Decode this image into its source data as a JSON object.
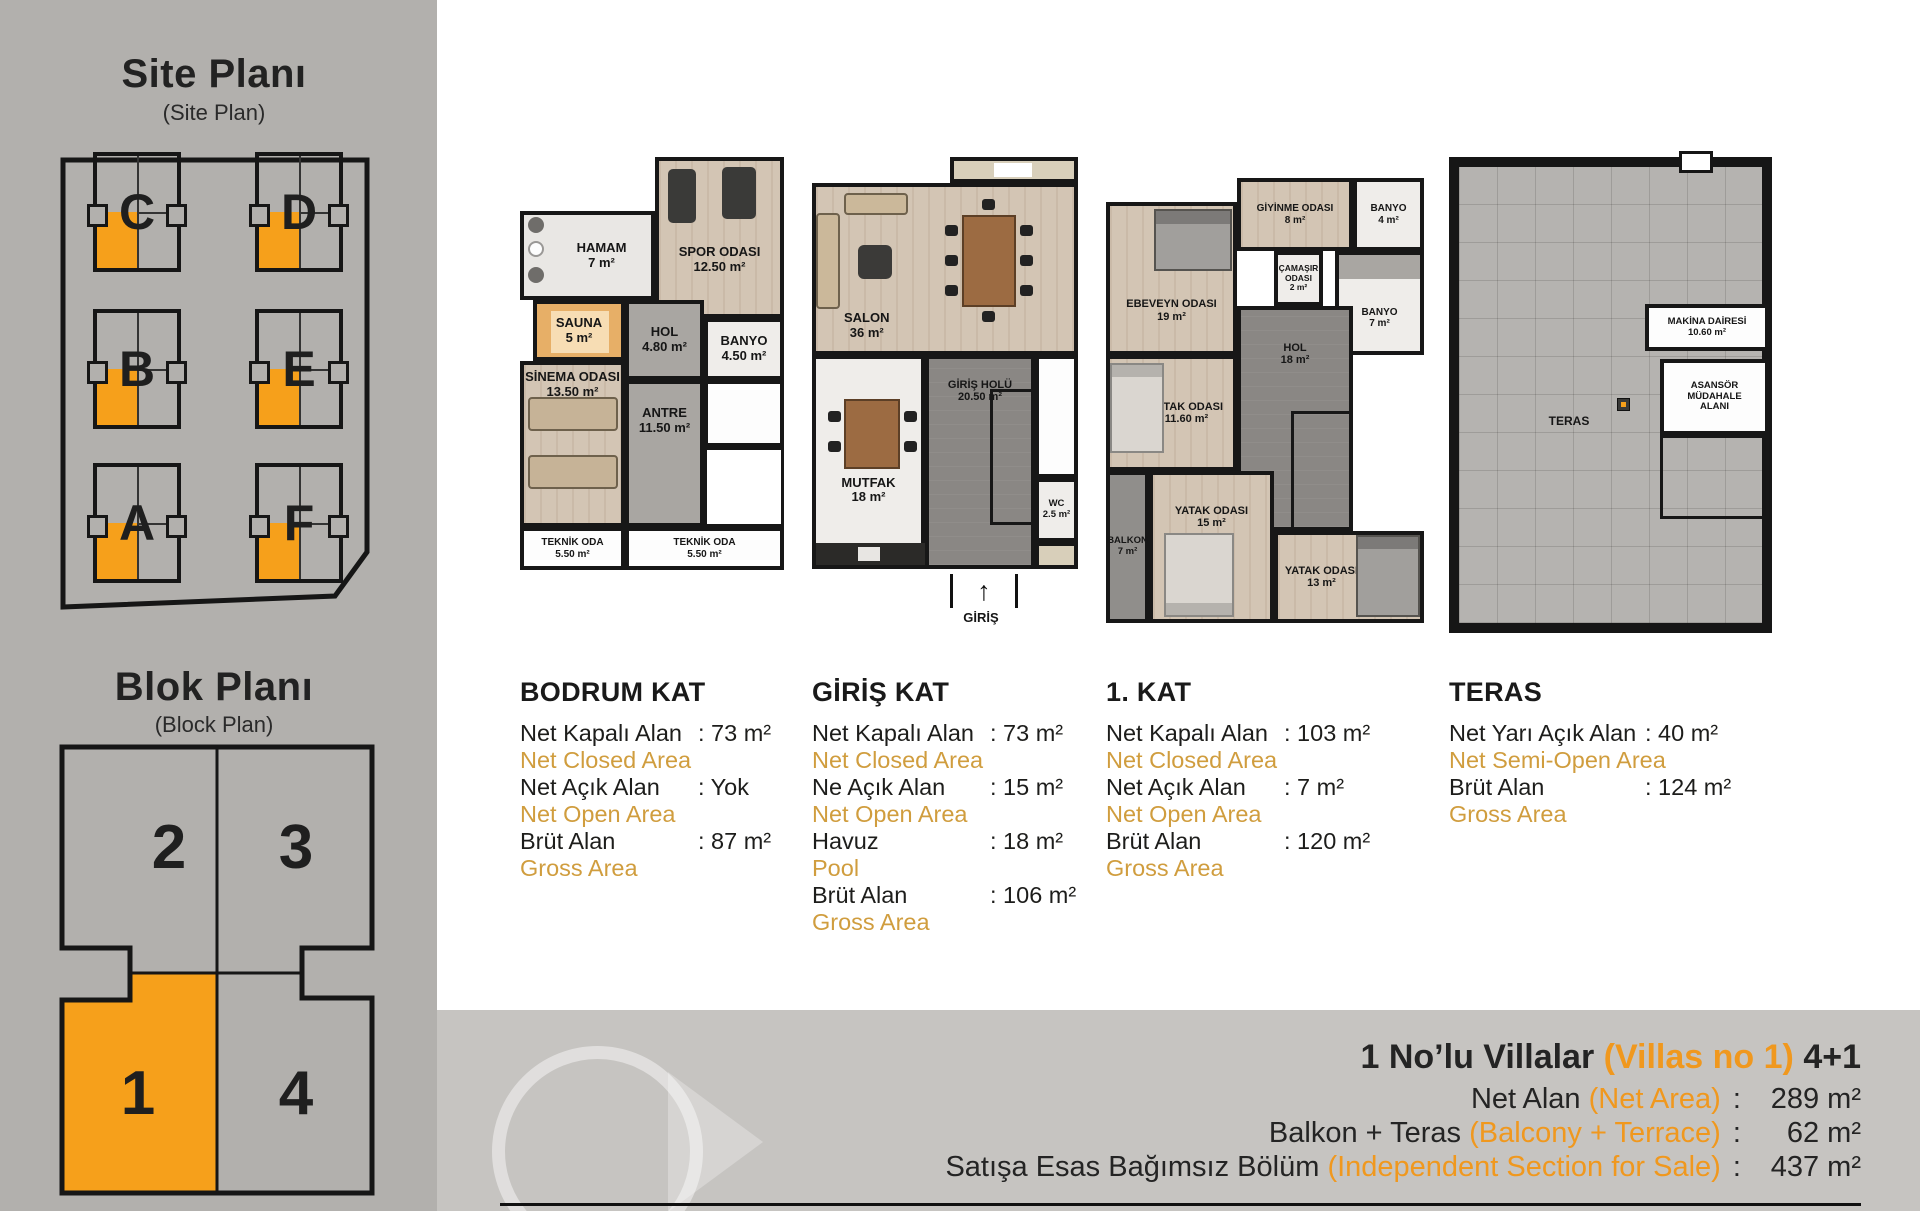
{
  "colors": {
    "accent_orange": "#f6a01b",
    "translation_gold": "#d09d3e",
    "summary_orange": "#f0981e"
  },
  "sidebar": {
    "site_plan": {
      "title": "Site Planı",
      "subtitle": "(Site Plan)",
      "blocks": [
        {
          "label": "C"
        },
        {
          "label": "D"
        },
        {
          "label": "B"
        },
        {
          "label": "E"
        },
        {
          "label": "A"
        },
        {
          "label": "F"
        }
      ]
    },
    "block_plan": {
      "title": "Blok Planı",
      "subtitle": "(Block Plan)",
      "units": [
        {
          "label": "2"
        },
        {
          "label": "3"
        },
        {
          "label": "1"
        },
        {
          "label": "4"
        }
      ],
      "highlighted_unit": "1"
    }
  },
  "floors": [
    {
      "title": "BODRUM KAT",
      "rooms": {
        "hamam": {
          "name": "HAMAM",
          "area": "7 m²"
        },
        "spor": {
          "name": "SPOR ODASI",
          "area": "12.50 m²"
        },
        "sauna": {
          "name": "SAUNA",
          "area": "5 m²"
        },
        "hol": {
          "name": "HOL",
          "area": "4.80 m²"
        },
        "banyo": {
          "name": "BANYO",
          "area": "4.50 m²"
        },
        "sinema": {
          "name": "SİNEMA ODASI",
          "area": "13.50 m²"
        },
        "antre": {
          "name": "ANTRE",
          "area": "11.50 m²"
        },
        "teknik1": {
          "name": "TEKNİK ODA",
          "area": "5.50 m²"
        },
        "teknik2": {
          "name": "TEKNİK ODA",
          "area": "5.50 m²"
        }
      },
      "stats": [
        {
          "label": "Net Kapalı Alan",
          "value": ": 73 m²",
          "translation": "Net Closed Area"
        },
        {
          "label": "Net Açık Alan",
          "value": ": Yok",
          "translation": "Net Open Area"
        },
        {
          "label": "Brüt Alan",
          "value": ": 87 m²",
          "translation": "Gross Area"
        }
      ]
    },
    {
      "title": "GİRİŞ KAT",
      "rooms": {
        "salon": {
          "name": "SALON",
          "area": "36 m²"
        },
        "giris_holu": {
          "name": "GİRİŞ HOLÜ",
          "area": "20.50 m²"
        },
        "mutfak": {
          "name": "MUTFAK",
          "area": "18 m²"
        },
        "wc": {
          "name": "WC",
          "area": "2.5 m²"
        }
      },
      "entrance": {
        "label": "GİRİŞ",
        "arrow": "↑"
      },
      "stats": [
        {
          "label": "Net Kapalı Alan",
          "value": ": 73 m²",
          "translation": "Net Closed Area"
        },
        {
          "label": "Ne Açık Alan",
          "value": ": 15 m²",
          "translation": "Net Open Area"
        },
        {
          "label": "Havuz",
          "value": ": 18 m²",
          "translation": "Pool"
        },
        {
          "label": "Brüt Alan",
          "value": ": 106 m²",
          "translation": "Gross Area"
        }
      ]
    },
    {
      "title": "1. KAT",
      "rooms": {
        "ebeveyn": {
          "name": "EBEVEYN ODASI",
          "area": "19 m²"
        },
        "giyinme": {
          "name": "GİYİNME ODASI",
          "area": "8 m²"
        },
        "banyo_ust": {
          "name": "BANYO",
          "area": "4 m²"
        },
        "camasir": {
          "name": "ÇAMAŞIR ODASI",
          "area": "2 m²"
        },
        "banyo_alt": {
          "name": "BANYO",
          "area": "7 m²"
        },
        "hol": {
          "name": "HOL",
          "area": "18 m²"
        },
        "yatak_1": {
          "name": "YATAK ODASI",
          "area": "11.60 m²"
        },
        "yatak_2": {
          "name": "YATAK ODASI",
          "area": "15 m²"
        },
        "yatak_3": {
          "name": "YATAK ODASI",
          "area": "13 m²"
        },
        "balkon": {
          "name": "BALKON",
          "area": "7 m²"
        }
      },
      "stats": [
        {
          "label": "Net Kapalı Alan",
          "value": ": 103 m²",
          "translation": "Net Closed Area"
        },
        {
          "label": "Net Açık Alan",
          "value": ": 7 m²",
          "translation": "Net Open Area"
        },
        {
          "label": "Brüt Alan",
          "value": ": 120 m²",
          "translation": "Gross Area"
        }
      ]
    },
    {
      "title": "TERAS",
      "rooms": {
        "makina": {
          "name": "MAKİNA DAİRESİ",
          "area": "10.60 m²"
        },
        "asansor": {
          "name": "ASANSÖR MÜDAHALE ALANI"
        },
        "teras": {
          "name": "TERAS"
        }
      },
      "stats": [
        {
          "label": "Net Yarı Açık Alan",
          "value": ": 40 m²",
          "translation": "Net Semi-Open Area"
        },
        {
          "label": "Brüt Alan",
          "value": ": 124 m²",
          "translation": "Gross Area"
        }
      ]
    }
  ],
  "summary": {
    "title": {
      "black": "1 No’lu Villalar",
      "orange": "(Villas no 1)",
      "suffix": "4+1"
    },
    "rows": [
      {
        "label": "Net Alan",
        "label_en": "(Net Area)",
        "sep": ":",
        "value": "289 m²"
      },
      {
        "label": "Balkon + Teras",
        "label_en": "(Balcony + Terrace)",
        "sep": ":",
        "value": "62 m²"
      },
      {
        "label": "Satışa Esas Bağımsız Bölüm",
        "label_en": "(Independent Section for Sale)",
        "sep": ":",
        "value": "437 m²"
      }
    ]
  }
}
